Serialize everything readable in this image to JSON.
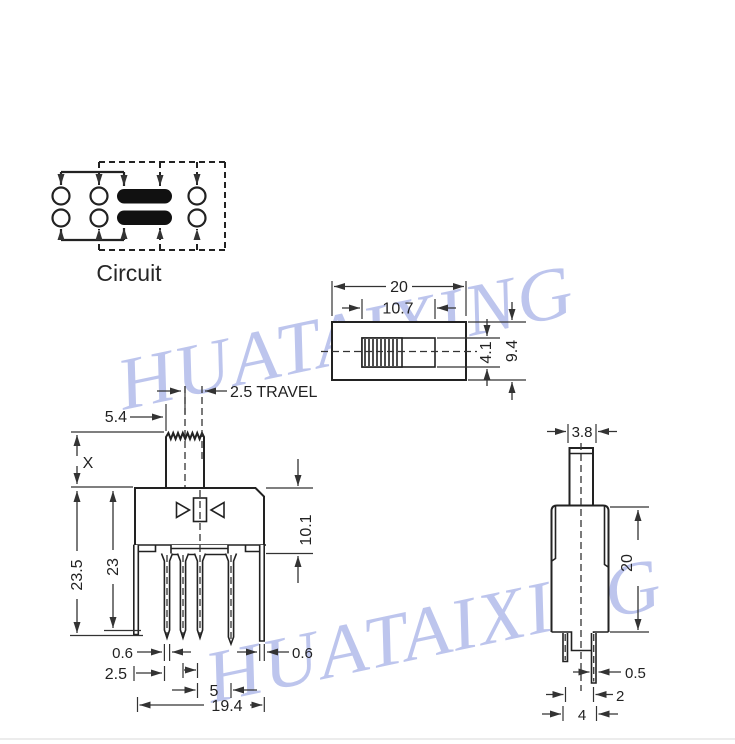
{
  "watermark": {
    "text": "HUATAIXING",
    "color": "#8291dd"
  },
  "circuit": {
    "label": "Circuit"
  },
  "top_view": {
    "dim_overall_width": "20",
    "dim_knob_slot_width": "10.7",
    "dim_slot_height": "4.1",
    "dim_overall_depth": "9.4"
  },
  "front_view": {
    "dim_travel": "2.5 TRAVEL",
    "dim_knob_offset": "5.4",
    "dim_knob_height": "X",
    "dim_overall_height": "23.5",
    "dim_pin_depth": "23",
    "dim_body_height": "10.1",
    "dim_side_pin_width_left": "0.6",
    "dim_side_pin_width_right": "0.6",
    "dim_pin_pitch_small": "2.5",
    "dim_pin_pitch_large": "5",
    "dim_pin_span": "19.4"
  },
  "side_view": {
    "dim_knob_width": "3.8",
    "dim_body_height": "20",
    "dim_pin_thickness": "0.5",
    "dim_pin_gap": "2",
    "dim_pin_span": "4"
  }
}
